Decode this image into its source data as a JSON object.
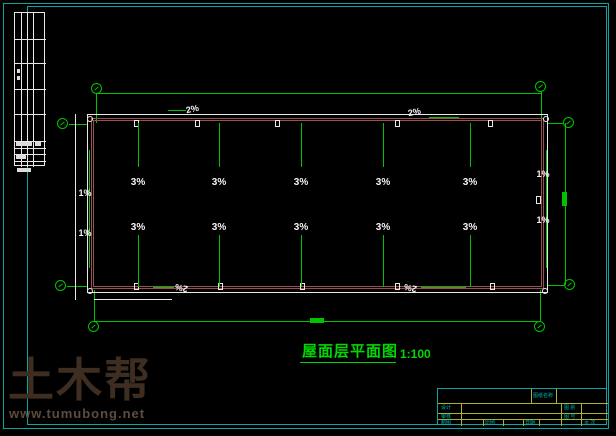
{
  "frame": {
    "color": "#0fa4a4"
  },
  "title": {
    "name": "屋面层平面图",
    "scale": "1:100"
  },
  "watermark": {
    "brand": "土木帮",
    "url": "www.tumubong.net"
  },
  "drawing": {
    "slopes_top": [
      "3%",
      "3%",
      "3%",
      "3%",
      "3%"
    ],
    "slopes_bottom": [
      "3%",
      "3%",
      "3%",
      "3%",
      "3%"
    ],
    "left_slopes": [
      "1%",
      "1%"
    ],
    "right_slopes": [
      "1%",
      "1%"
    ],
    "gutter_slopes": [
      "2%",
      "2%",
      "2%",
      "2%"
    ]
  },
  "titleblock": {
    "drawing_name_label": "图纸名称",
    "design_label": "设计",
    "check_label": "审核",
    "draft_label": "制图",
    "scale_label": "比例",
    "date_label": "日期",
    "category_label": "图 别",
    "number_label": "图 号",
    "page_label": "页 次"
  }
}
